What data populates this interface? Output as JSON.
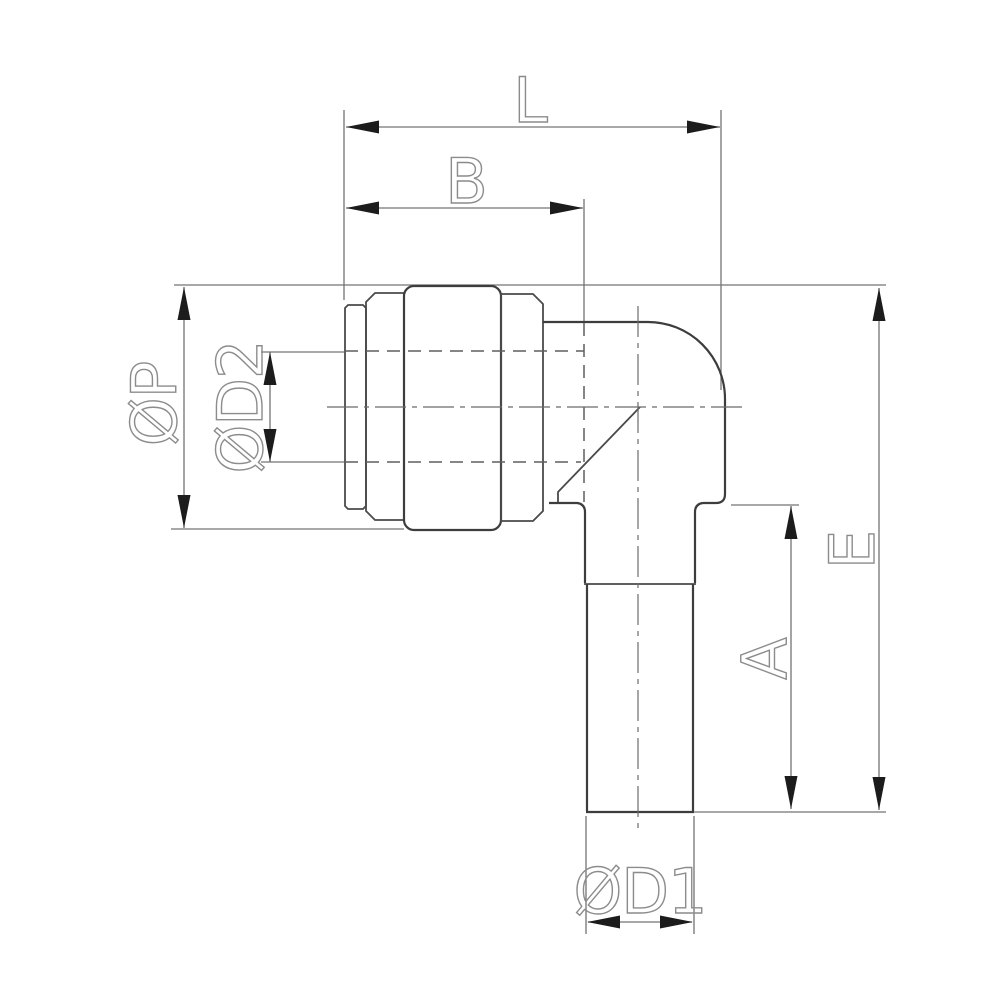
{
  "drawing": {
    "type": "technical-dimension-drawing",
    "view": "side elevation of 90-degree elbow push-in fitting",
    "colors": {
      "background": "#ffffff",
      "outline": "#3d3d3d",
      "dimension_lines": "#747474",
      "hidden_lines": "#5f5f5f",
      "centerlines": "#6b6b6b",
      "arrows": "#1c1c1c",
      "labels": "#8c8c8c"
    },
    "labels": {
      "L": "L",
      "B": "B",
      "P": "ØP",
      "D2": "ØD2",
      "A": "A",
      "E": "E",
      "D1": "ØD1"
    }
  }
}
